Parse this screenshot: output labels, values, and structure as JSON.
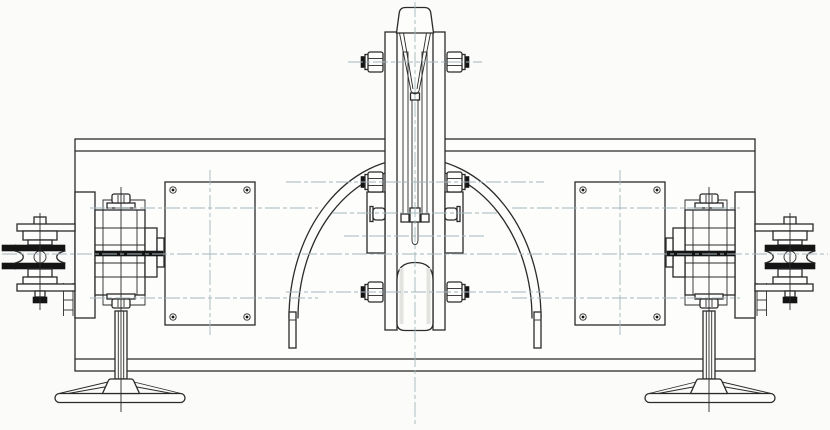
{
  "document": {
    "kind": "engineering-drawing",
    "view": "front-elevation",
    "description": "Mechanical beam assembly with central sheave block, semicircular guard arc, two access plates, side bearing units, double-flange chain pulleys and pedestal support stands",
    "visible_text": []
  },
  "colors": {
    "background": "#fbfbf9",
    "paper": "#fdfdfc",
    "line": "#2b2b2b",
    "dark": "#141414",
    "centerline": "#a3b6bb",
    "shading": "#e3e3e0"
  },
  "components": [
    {
      "label": "Main beam housing"
    },
    {
      "label": "Left access plate with corner screws"
    },
    {
      "label": "Right access plate with corner screws"
    },
    {
      "label": "Central sheave / clevis assembly"
    },
    {
      "label": "Top shackle bracket"
    },
    {
      "label": "Semicircular guard arc with end pipes"
    },
    {
      "label": "Left bearing / hub unit"
    },
    {
      "label": "Right bearing / hub unit"
    },
    {
      "label": "Left grooved chain pulley"
    },
    {
      "label": "Right grooved chain pulley"
    },
    {
      "label": "Left pedestal support stand"
    },
    {
      "label": "Right pedestal support stand"
    },
    {
      "label": "Mechanical assembly front view"
    },
    {
      "label": "Centerline layer"
    }
  ]
}
